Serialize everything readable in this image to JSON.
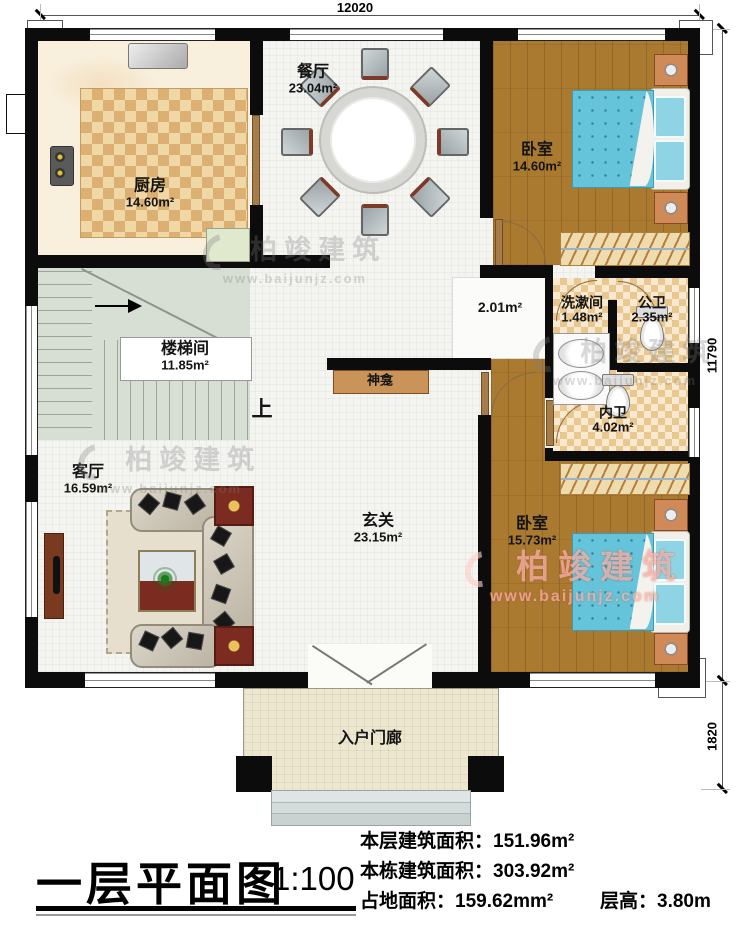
{
  "plan": {
    "dimensions": {
      "width_top": "12020",
      "height_right": "11790",
      "porch_right": "1820"
    },
    "rooms": {
      "kitchen": {
        "name": "厨房",
        "area": "14.60m²"
      },
      "dining": {
        "name": "餐厅",
        "area": "23.04m²"
      },
      "bedroom_top": {
        "name": "卧室",
        "area": "14.60m²"
      },
      "washroom": {
        "name": "洗漱间",
        "area": "1.48m²"
      },
      "public_bath": {
        "name": "公卫",
        "area": "2.35m²"
      },
      "ensuite_bath": {
        "name": "内卫",
        "area": "4.02m²"
      },
      "stairwell": {
        "name": "楼梯间",
        "area": "11.85m²"
      },
      "living": {
        "name": "客厅",
        "area": "16.59m²"
      },
      "foyer": {
        "name": "玄关",
        "area": "23.15m²"
      },
      "bedroom_bottom": {
        "name": "卧室",
        "area": "15.73m²"
      },
      "porch": {
        "name": "入户门廊"
      },
      "hall_area": {
        "area": "2.01m²"
      },
      "shrine": {
        "name": "神龛"
      },
      "stairs_up": {
        "label": "上"
      }
    },
    "watermark": {
      "brand": "柏竣建筑",
      "url": "www.baijunjz.com"
    },
    "colors": {
      "wall": "#0c0c0c",
      "wood_floor": "#ab7a31",
      "bed": "#66c4da",
      "bath_tile": "#e9c78e",
      "stairs": "#d7ded3",
      "watermark_red": "#c23b30"
    }
  },
  "title_block": {
    "title": "一层平面图",
    "scale": "1:100",
    "stats": [
      {
        "label": "本层建筑面积：",
        "value": "151.96m²"
      },
      {
        "label": "本栋建筑面积：",
        "value": "303.92m²"
      },
      {
        "label": "占地面积：",
        "value": "159.62mm²"
      },
      {
        "label": "层高：",
        "value": "3.80m"
      }
    ]
  }
}
